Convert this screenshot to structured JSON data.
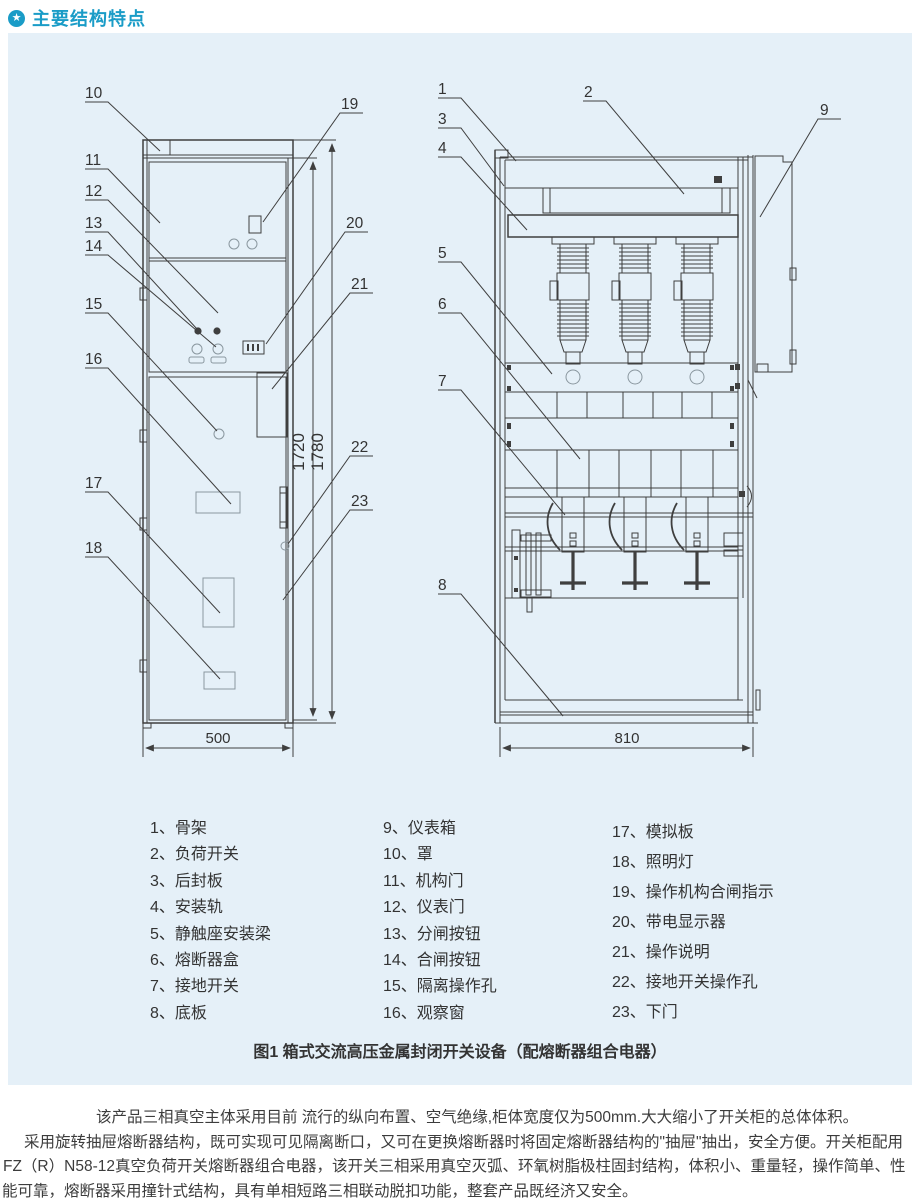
{
  "header": {
    "icon": "star-circle-icon",
    "icon_glyph": "★",
    "title": "主要结构特点"
  },
  "colors": {
    "accent": "#1a9cc7",
    "panel_bg": "#e5f0f8",
    "line": "#3f3f3f",
    "text": "#333333"
  },
  "figure": {
    "caption": "图1 箱式交流高压金属封闭开关设备（配熔断器组合电器）",
    "callouts_front": [
      "10",
      "11",
      "12",
      "13",
      "14",
      "15",
      "16",
      "17",
      "18",
      "19",
      "20",
      "21",
      "22",
      "23"
    ],
    "callouts_side": [
      "1",
      "2",
      "3",
      "4",
      "5",
      "6",
      "7",
      "8",
      "9"
    ],
    "dims": {
      "front_width": "500",
      "side_depth": "810",
      "height_body": "1720",
      "height_total": "1780"
    }
  },
  "legend": {
    "col1": [
      "1、骨架",
      "2、负荷开关",
      "3、后封板",
      "4、安装轨",
      "5、静触座安装梁",
      "6、熔断器盒",
      "7、接地开关",
      "8、底板"
    ],
    "col2": [
      "9、仪表箱",
      "10、罩",
      "11、机构门",
      "12、仪表门",
      "13、分闸按钮",
      "14、合闸按钮",
      "15、隔离操作孔",
      "16、观察窗"
    ],
    "col3": [
      "17、模拟板",
      "18、照明灯",
      "19、操作机构合闸指示",
      "20、带电显示器",
      "21、操作说明",
      "22、接地开关操作孔",
      "23、下门"
    ]
  },
  "description": {
    "line1": "该产品三相真空主体采用目前 流行的纵向布置、空气绝缘,柜体宽度仅为500mm.大大缩小了开关柜的总体体积。",
    "line2": "采用旋转抽屉熔断器结构，既可实现可见隔离断口，又可在更换熔断器时将固定熔断器结构的\"抽屉\"抽出，安全方便。开关柜配用",
    "line3": "FZ（R）N58-12真空负荷开关熔断器组合电器，该开关三相采用真空灭弧、环氧树脂极柱固封结构，体积小、重量轻，操作简单、性",
    "line4": "能可靠，熔断器采用撞针式结构，具有单相短路三相联动脱扣功能，整套产品既经济又安全。"
  }
}
